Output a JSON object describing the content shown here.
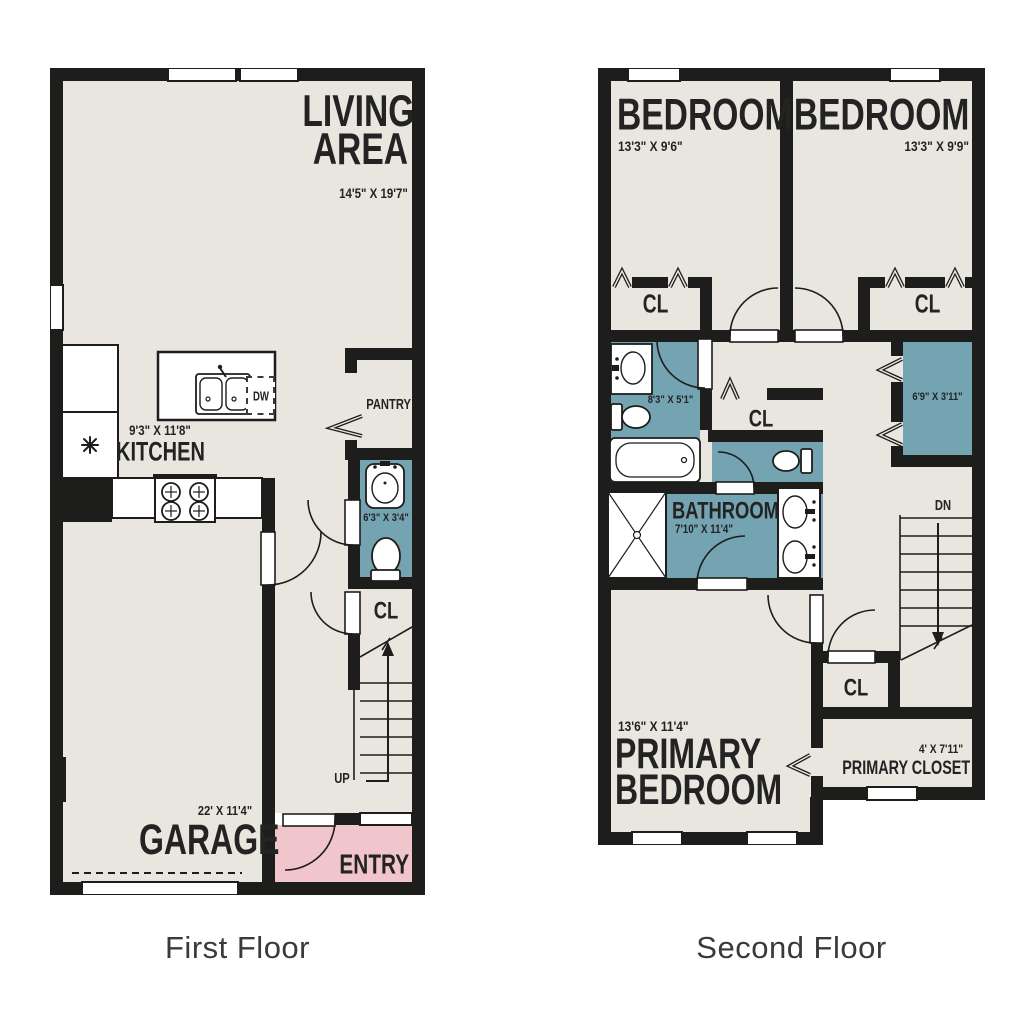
{
  "colors": {
    "wall": "#1d1d1b",
    "floor": "#e9e6df",
    "wet_room": "#74a3b1",
    "entry": "#f0c5cc",
    "page_bg": "#ffffff",
    "label_text": "#232323"
  },
  "floor1": {
    "title": "First Floor",
    "living": {
      "label": "LIVING AREA",
      "dims": "14'5\" X 19'7\""
    },
    "kitchen": {
      "label": "KITCHEN",
      "dims": "9'3\" X 11'8\""
    },
    "pantry": {
      "label": "PANTRY"
    },
    "bath": {
      "dims": "6'3\" X 3'4\""
    },
    "closet": {
      "label": "CL"
    },
    "stairs": {
      "label": "UP"
    },
    "garage": {
      "label": "GARAGE",
      "dims": "22' X 11'4\""
    },
    "entry": {
      "label": "ENTRY"
    },
    "dishwasher": {
      "label": "DW"
    }
  },
  "floor2": {
    "title": "Second Floor",
    "bedroom1": {
      "label": "BEDROOM",
      "dims": "13'3\" X 9'6\""
    },
    "bedroom2": {
      "label": "BEDROOM",
      "dims": "13'3\" X 9'9\""
    },
    "closet1": {
      "label": "CL"
    },
    "closet2": {
      "label": "CL"
    },
    "bath1": {
      "dims": "8'3\" X 5'1\""
    },
    "hall_closet": {
      "label": "CL"
    },
    "linen_closet": {
      "dims": "6'9\" X 3'11\""
    },
    "bathroom": {
      "label": "BATHROOM",
      "dims": "7'10\" X 11'4\""
    },
    "closet3": {
      "label": "CL"
    },
    "stairs": {
      "label": "DN"
    },
    "primary_bedroom": {
      "label": "PRIMARY BEDROOM",
      "dims": "13'6\" X 11'4\""
    },
    "primary_closet": {
      "label": "PRIMARY CLOSET",
      "dims": "4' X 7'11\""
    }
  }
}
